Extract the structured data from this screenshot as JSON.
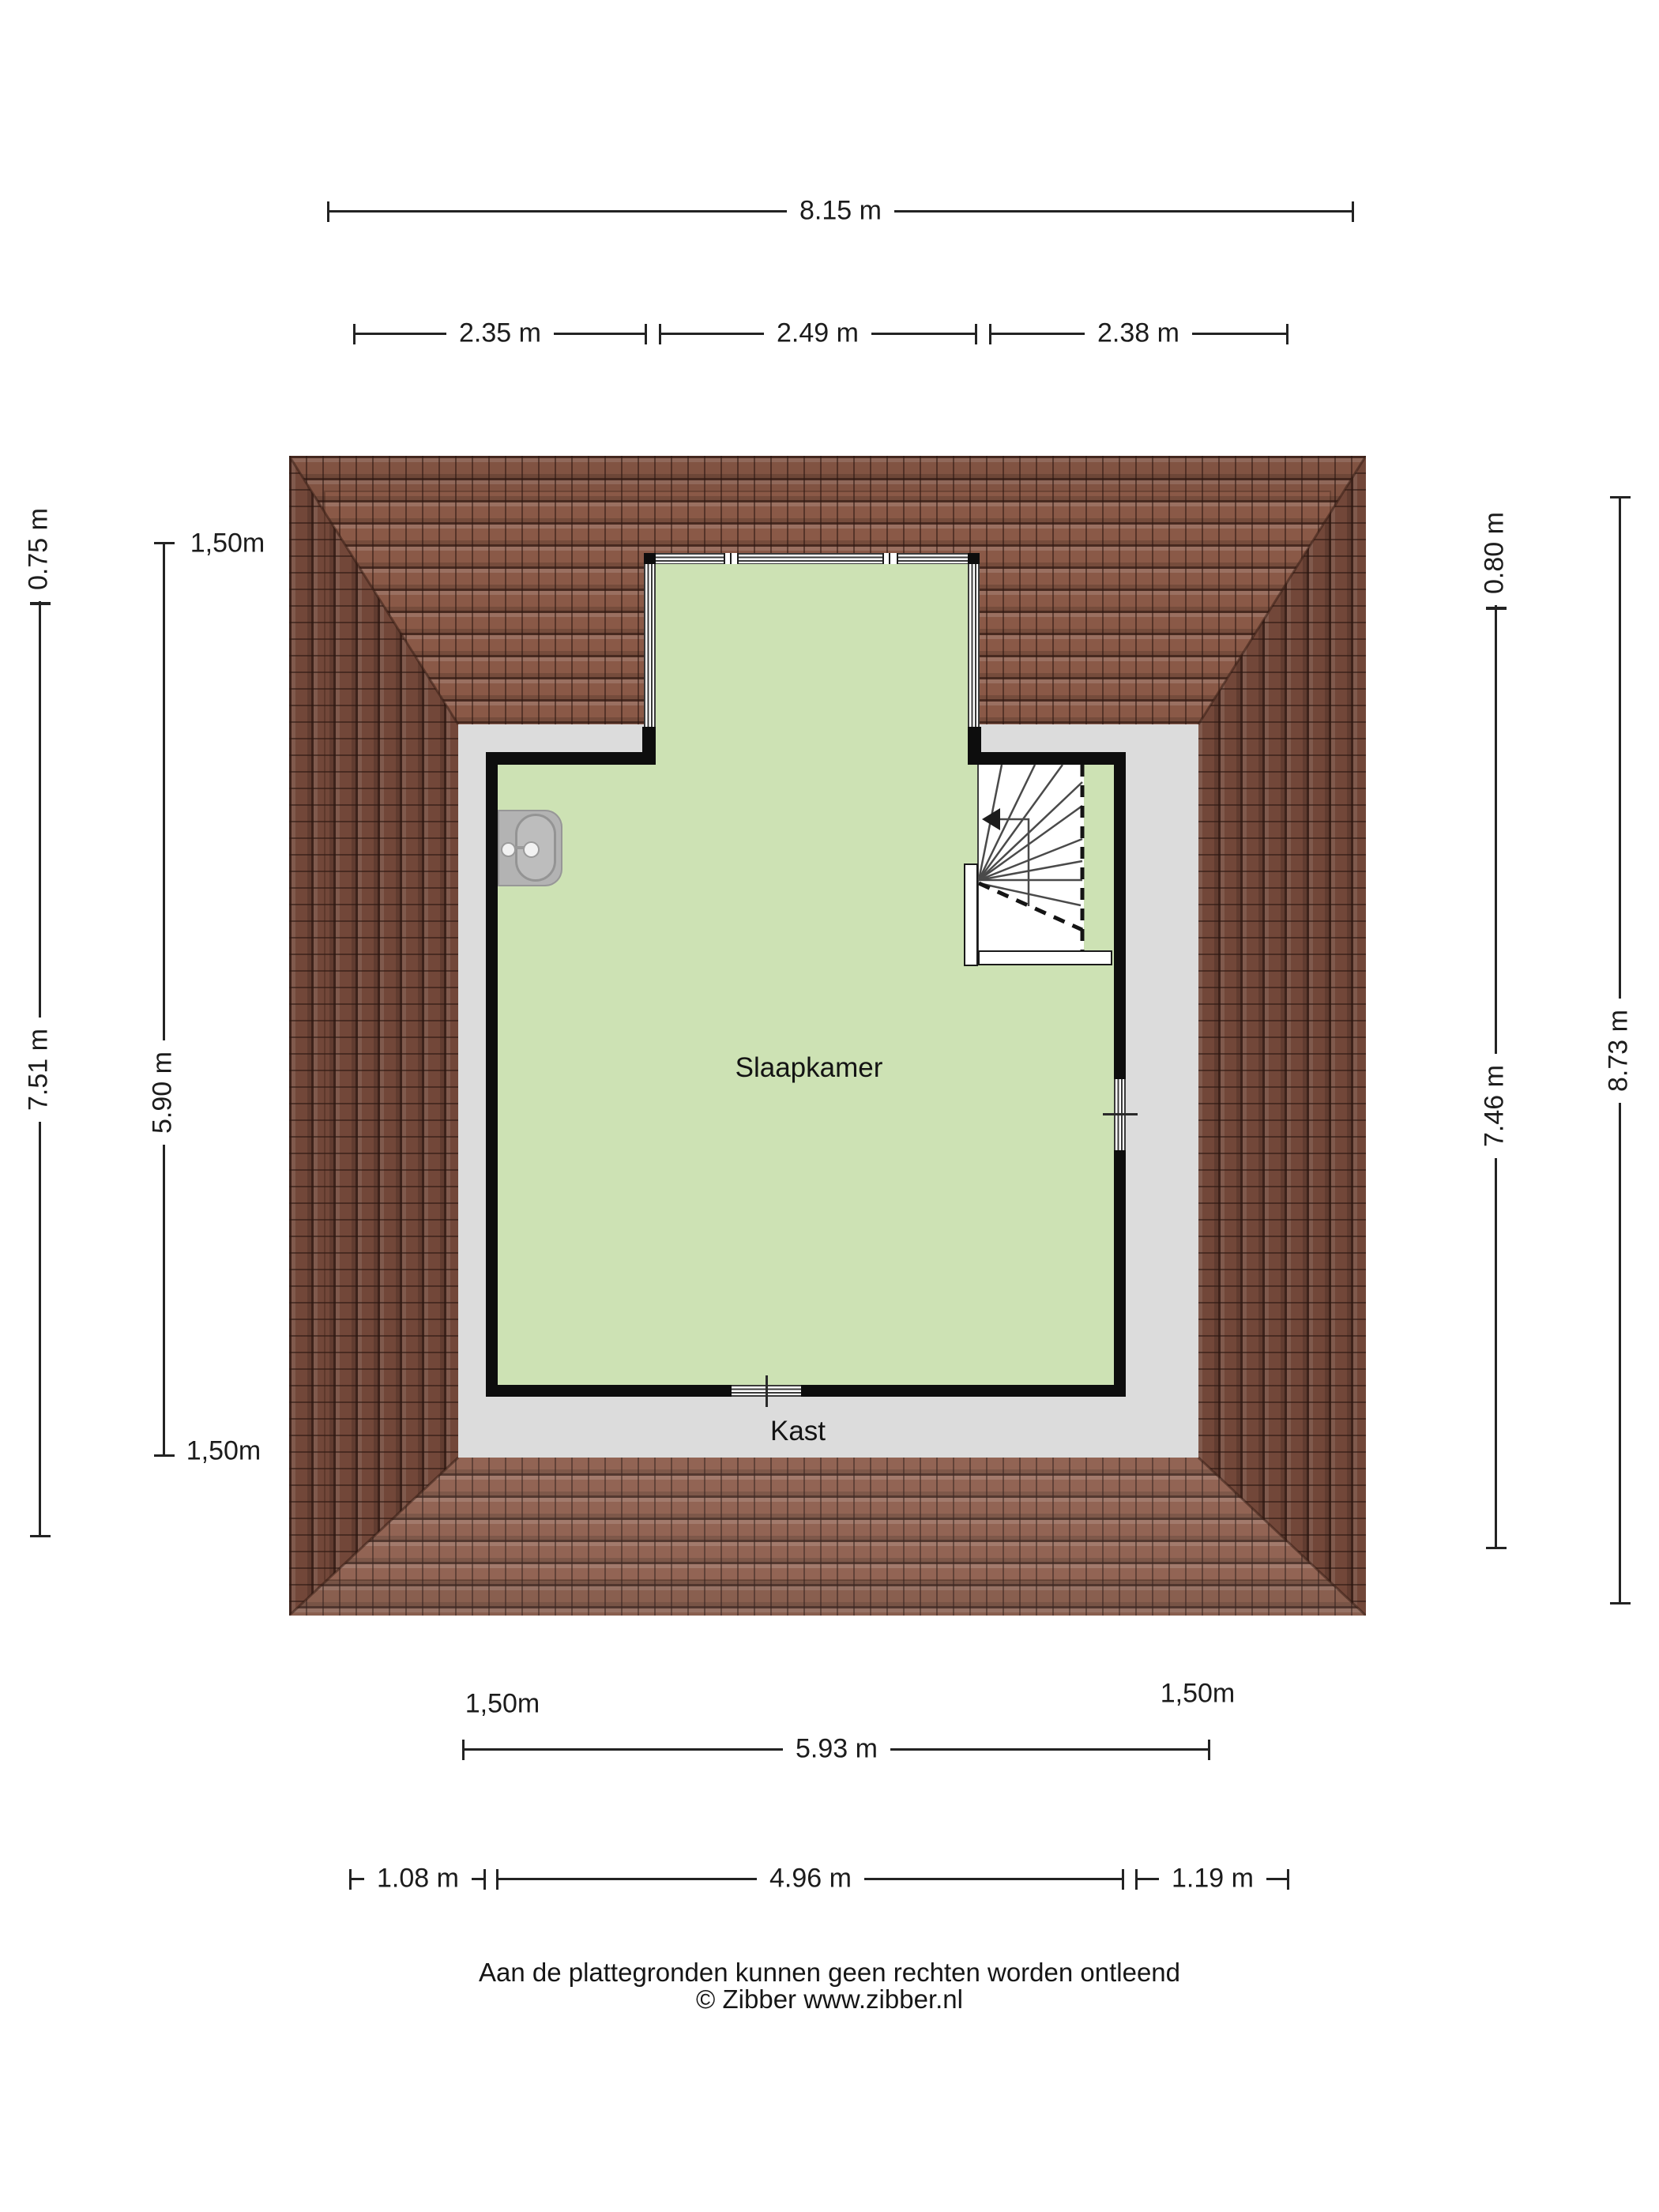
{
  "dimensions": {
    "top_total": "8.15 m",
    "top_segments": [
      "2.35 m",
      "2.49 m",
      "2.38 m"
    ],
    "left_eave": "0.75 m",
    "left_height": "7.51 m",
    "left_clearance_top": "1,50m",
    "left_inner_height": "5.90 m",
    "left_clearance_bottom": "1,50m",
    "right_eave": "0.80 m",
    "right_height": "7.46 m",
    "right_total": "8.73 m",
    "bottom_clearance_left": "1,50m",
    "bottom_clearance_right": "1,50m",
    "bottom_inner_width": "5.93 m",
    "bottom_segments": [
      "1.08 m",
      "4.96 m",
      "1.19 m"
    ]
  },
  "labels": {
    "bedroom": "Slaapkamer",
    "closet": "Kast"
  },
  "footer": {
    "disclaimer": "Aan de plattegronden kunnen geen rechten worden ontleend",
    "credit": "© Zibber www.zibber.nl"
  },
  "colors": {
    "room_fill": "#cde2b4",
    "flat_roof": "#dcdcdc",
    "roof_tile": "#8a5947",
    "roof_tile_side": "#7f4f3f",
    "wall": "#0d0d0d",
    "sink": "#b3b3b3"
  }
}
